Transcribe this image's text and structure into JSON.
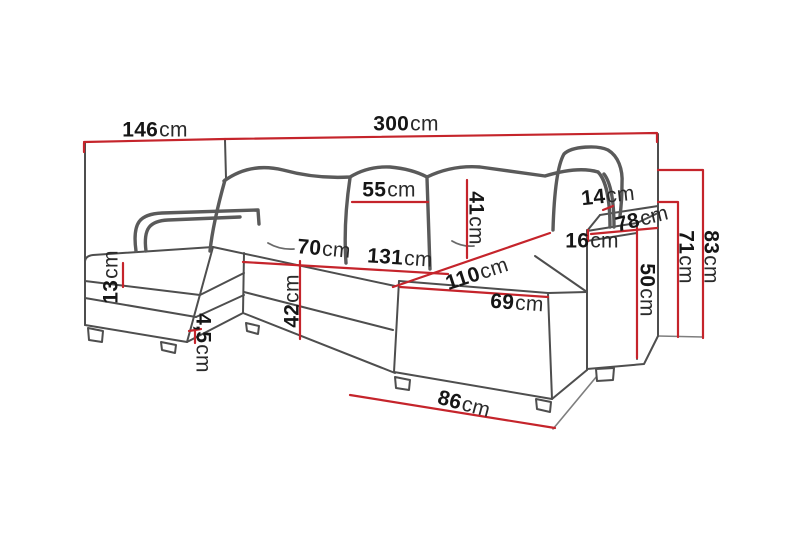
{
  "meta": {
    "description": "Dimension diagram of a U-shaped sectional sofa, line drawing with red measurement lines",
    "unit": "cm"
  },
  "colors": {
    "dimension_line": "#c5242b",
    "sofa_outline": "#4e4e4e",
    "label_text": "#161616",
    "background": "#ffffff"
  },
  "dimensions": {
    "d146": {
      "value": "146",
      "unit": "cm"
    },
    "d300": {
      "value": "300",
      "unit": "cm"
    },
    "d55": {
      "value": "55",
      "unit": "cm"
    },
    "d41": {
      "value": "41",
      "unit": "cm"
    },
    "d14": {
      "value": "14",
      "unit": "cm"
    },
    "d78": {
      "value": "78",
      "unit": "cm"
    },
    "d16": {
      "value": "16",
      "unit": "cm"
    },
    "d83": {
      "value": "83",
      "unit": "cm"
    },
    "d71": {
      "value": "71",
      "unit": "cm"
    },
    "d50": {
      "value": "50",
      "unit": "cm"
    },
    "d70": {
      "value": "70",
      "unit": "cm"
    },
    "d131": {
      "value": "131",
      "unit": "cm"
    },
    "d110": {
      "value": "110",
      "unit": "cm"
    },
    "d69": {
      "value": "69",
      "unit": "cm"
    },
    "d42": {
      "value": "42",
      "unit": "cm"
    },
    "d13": {
      "value": "13",
      "unit": "cm"
    },
    "d45": {
      "value": "4,5",
      "unit": "cm"
    },
    "d86": {
      "value": "86",
      "unit": "cm"
    }
  }
}
